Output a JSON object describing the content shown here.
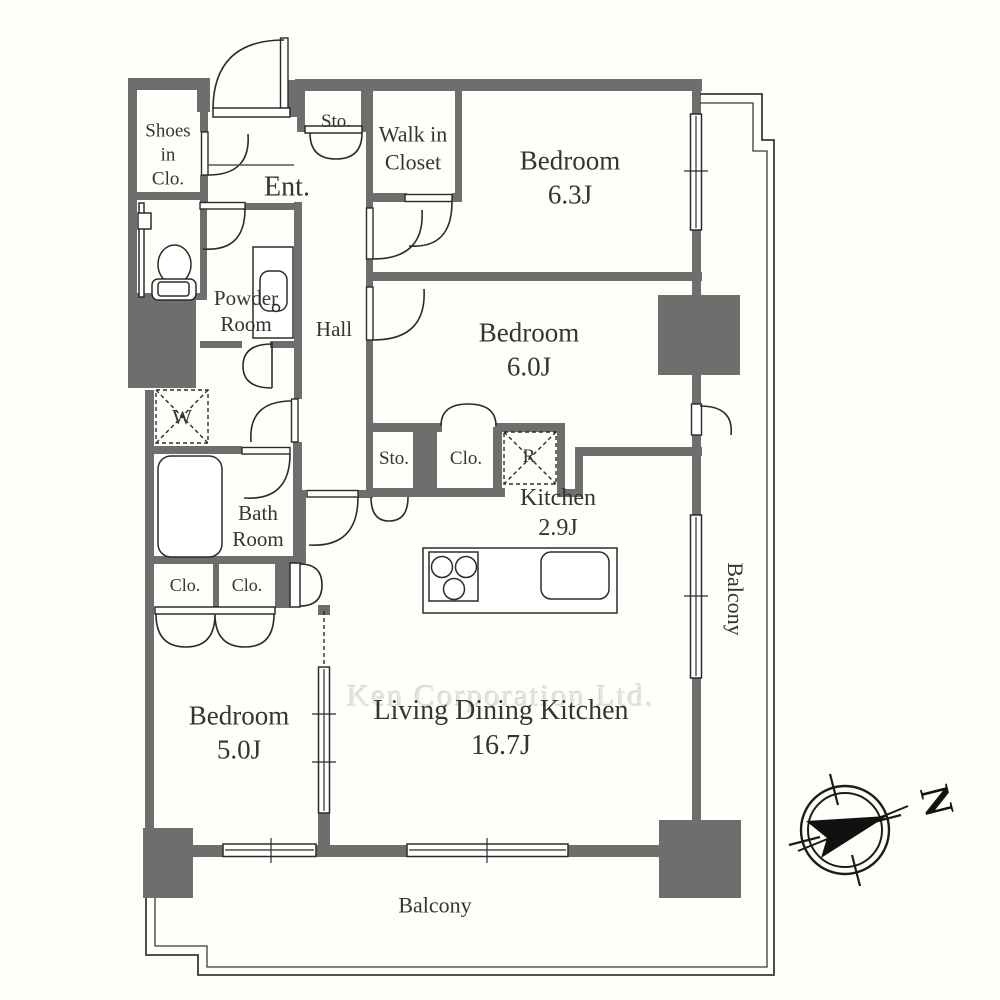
{
  "floorplan": {
    "rooms": {
      "shoes_closet": {
        "label": "Shoes\nin\nClo."
      },
      "entrance": {
        "label": "Ent."
      },
      "storage_entrance": {
        "label": "Sto."
      },
      "walk_in_closet": {
        "label": "Walk in\nCloset"
      },
      "bedroom_63": {
        "label": "Bedroom\n6.3J"
      },
      "powder_room": {
        "label": "Powder\nRoom"
      },
      "hall": {
        "label": "Hall"
      },
      "bedroom_60": {
        "label": "Bedroom\n6.0J"
      },
      "washer_slot": {
        "label": "W"
      },
      "storage_hall": {
        "label": "Sto."
      },
      "closet_hall": {
        "label": "Clo."
      },
      "refrigerator_slot": {
        "label": "R"
      },
      "kitchen": {
        "label": "Kitchen\n2.9J"
      },
      "bathroom": {
        "label": "Bath\nRoom"
      },
      "closet_left": {
        "label": "Clo."
      },
      "closet_right": {
        "label": "Clo."
      },
      "bedroom_50": {
        "label": "Bedroom\n5.0J"
      },
      "ldk": {
        "label": "Living Dining Kitchen\n16.7J"
      },
      "balcony_east": {
        "label": "Balcony"
      },
      "balcony_south": {
        "label": "Balcony"
      }
    },
    "compass": {
      "north_label": "N"
    },
    "watermark": "Ken Corporation Ltd.",
    "colors": {
      "wall": "#6e6e6e",
      "line": "#2b2b2b",
      "background": "#fffef8",
      "label": "#343434",
      "watermark": "#e3e3e3"
    }
  }
}
